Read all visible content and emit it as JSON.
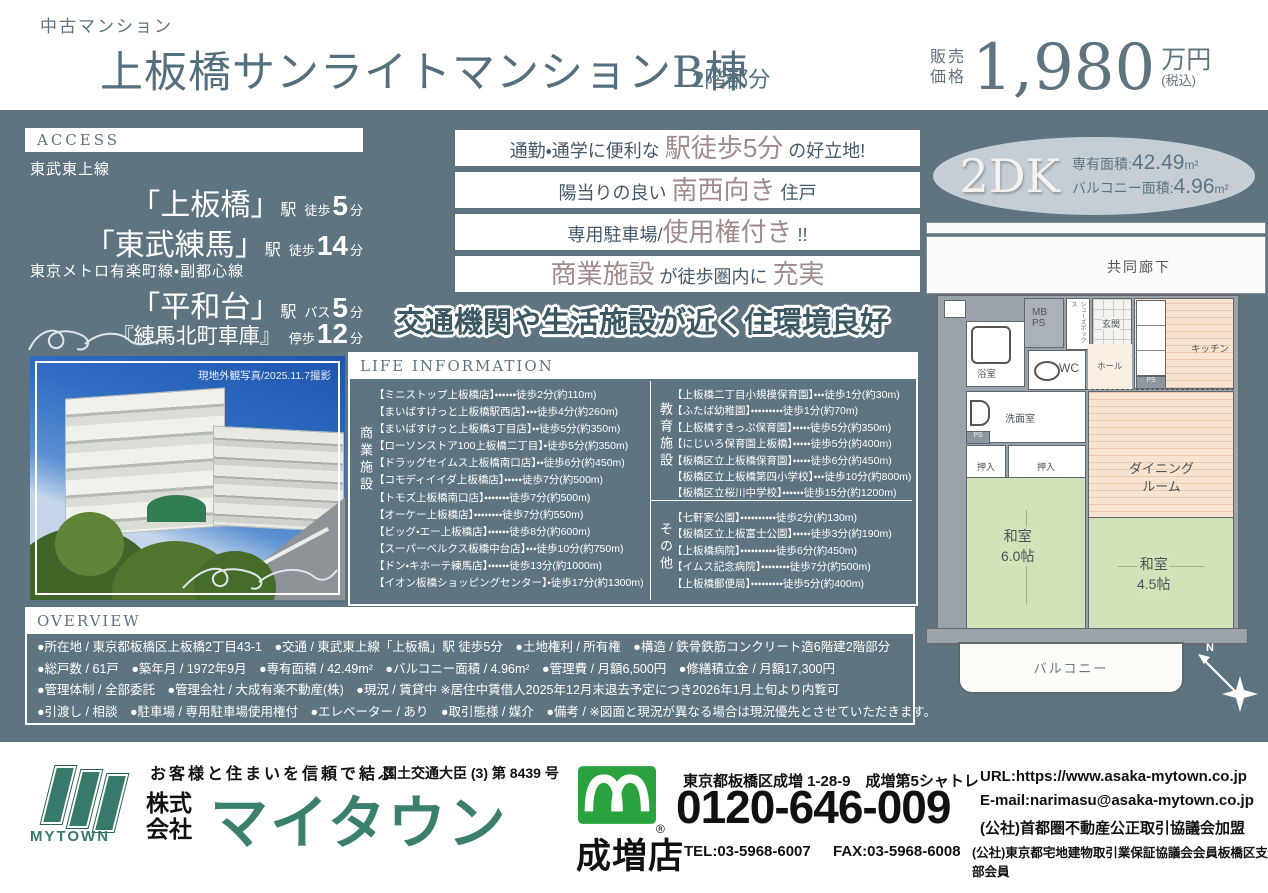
{
  "colors": {
    "slate": "#5e7481",
    "mauve": "#a18a8c",
    "dark_text": "#43596a",
    "footer_green": "#37796a",
    "freedial_green": "#2aa23e",
    "tatami_green": "#d2e2b8",
    "plan_beige": "#f7e4d0"
  },
  "header": {
    "category": "中古マンション",
    "title": "上板橋サンライトマンションB棟",
    "floor_note": "2階部分",
    "price_label1": "販売",
    "price_label2": "価格",
    "price_value": "1,980",
    "price_unit": "万円",
    "price_tax": "(税込)"
  },
  "access": {
    "heading": "ACCESS",
    "line1": "東武東上線",
    "line2": "東京メトロ有楽町線・副都心線",
    "stations": [
      {
        "name": "「上板橋」",
        "suffix": "駅",
        "mode": "徒歩",
        "min": "5",
        "unit": "分"
      },
      {
        "name": "「東武練馬」",
        "suffix": "駅",
        "mode": "徒歩",
        "min": "14",
        "unit": "分"
      },
      {
        "name": "「平和台」",
        "suffix": "駅",
        "mode": "バス",
        "min": "5",
        "unit": "分"
      },
      {
        "name": "『練馬北町車庫』",
        "suffix": "",
        "mode": "停歩",
        "min": "12",
        "unit": "分"
      }
    ]
  },
  "banners": {
    "b1": {
      "pre": "通勤・通学に便利な ",
      "accent": "駅徒歩5分",
      "post": " の好立地!"
    },
    "b2": {
      "pre": "陽当りの良い ",
      "accent": "南西向き",
      "post": " 住戸"
    },
    "b3": {
      "pre": "専用駐車場/",
      "accent": "使用権付き",
      "post": " !!"
    },
    "b4": {
      "accent1": "商業施設",
      "mid": " が徒歩圏内に ",
      "accent2": "充実"
    }
  },
  "catchphrase": "交通機関や生活施設が近く住環境良好",
  "unit_badge": {
    "type": "2DK",
    "area_label": "専有面積:",
    "area_value": "42.49",
    "area_unit": "m²",
    "balcony_label": "バルコニー面積:",
    "balcony_value": "4.96",
    "balcony_unit": "m²"
  },
  "photo": {
    "caption": "現地外観写真/2025.11.7撮影"
  },
  "life": {
    "heading": "LIFE INFORMATION",
    "col1_label": "商業施設",
    "col2a_label": "教育施設",
    "col2b_label": "その他",
    "commercial": [
      "【ミニストップ上板橋店】・・・・・・徒歩2分(約110m)",
      "【まいばすけっと上板橋駅西店】・・・徒歩4分(約260m)",
      "【まいばすけっと上板橋3丁目店】・・徒歩5分(約350m)",
      "【ローソンストア100上板橋二丁目】・徒歩5分(約350m)",
      "【ドラッグセイムス上板橋南口店】・・徒歩6分(約450m)",
      "【コモディイイダ上板橋店】・・・・・徒歩7分(約500m)",
      "【トモズ上板橋南口店】・・・・・・・徒歩7分(約500m)",
      "【オーケー上板橋店】・・・・・・・・徒歩7分(約550m)",
      "【ビッグ・エー上板橋店】・・・・・・徒歩8分(約600m)",
      "【スーパーベルクス板橋中台店】・・・徒歩10分(約750m)",
      "【ドン・キホーテ練馬店】・・・・・・徒歩13分(約1000m)",
      "【イオン板橋ショッピングセンター】・徒歩17分(約1300m)"
    ],
    "education": [
      "【上板橋二丁目小規模保育園】・・・徒歩1分(約30m)",
      "【ふたば幼稚園】・・・・・・・・・徒歩1分(約70m)",
      "【上板橋すきっぷ保育園】・・・・・徒歩5分(約350m)",
      "【にじいろ保育園上板橋】・・・・・徒歩5分(約400m)",
      "【板橋区立上板橋保育園】・・・・・徒歩6分(約450m)",
      "【板橋区立上板橋第四小学校】・・・徒歩10分(約800m)",
      "【板橋区立桜川中学校】・・・・・・徒歩15分(約1200m)"
    ],
    "other": [
      "【七軒家公園】・・・・・・・・・・徒歩2分(約130m)",
      "【板橋区立上板富士公園】・・・・・徒歩3分(約190m)",
      "【上板橋病院】・・・・・・・・・・徒歩6分(約450m)",
      "【イムス記念病院】・・・・・・・・徒歩7分(約500m)",
      "【上板橋郵便局】・・・・・・・・・徒歩5分(約400m)"
    ]
  },
  "overview": {
    "heading": "OVERVIEW",
    "lines": [
      "●所在地 / 東京都板橋区上板橋2丁目43-1　●交通 / 東武東上線「上板橋」駅 徒歩5分　●土地権利 / 所有権　●構造 / 鉄骨鉄筋コンクリート造6階建2階部分",
      "●総戸数 / 61戸　●築年月 / 1972年9月　●専有面積 / 42.49m²　●バルコニー面積 / 4.96m²　●管理費 / 月額6,500円　●修繕積立金 / 月額17,300円",
      "●管理体制 / 全部委託　●管理会社 / 大成有楽不動産(株)　●現況 / 賃貸中 ※居住中賃借人2025年12月末退去予定につき2026年1月上旬より内覧可",
      "●引渡し / 相談　●駐車場 / 専用駐車場使用権付　●エレベーター / あり　●取引態様 / 媒介　●備考 / ※図面と現況が異なる場合は現況優先とさせていただきます。"
    ]
  },
  "floorplan": {
    "corridor": "共同廊下",
    "mb": "MB",
    "ps": "PS",
    "shoes": "シューズボックス",
    "genkan": "玄関",
    "kitchen": "キッチン",
    "bath": "浴室",
    "wc": "WC",
    "hall": "ホール",
    "washroom": "洗面室",
    "closet": "押入",
    "dining_line1": "ダイニング",
    "dining_line2": "ルーム",
    "jroom6_name": "和室",
    "jroom6_size": "6.0帖",
    "jroom45_name": "和室",
    "jroom45_size": "4.5帖",
    "balcony": "バルコニー",
    "compass": "N"
  },
  "footer": {
    "slogan": "お客様と住まいを信頼で結ぶ",
    "license": "国土交通大臣 (3) 第 8439 号",
    "company_prefix1": "株式",
    "company_prefix2": "会社",
    "company_name": "マイタウン",
    "logo_text": "MYTOWN",
    "branch": "成増店",
    "reg": "®",
    "address": "東京都板橋区成増 1-28-9　成増第5シャトレ",
    "freedial": "0120-646-009",
    "tel": "TEL:03-5968-6007",
    "fax": "FAX:03-5968-6008",
    "url": "URL:https://www.asaka-mytown.co.jp",
    "email": "E-mail:narimasu@asaka-mytown.co.jp",
    "assoc1": "(公社)首都圏不動産公正取引協議会加盟",
    "assoc2": "(公社)東京都宅地建物取引業保証協議会会員板橋区支部会員"
  }
}
